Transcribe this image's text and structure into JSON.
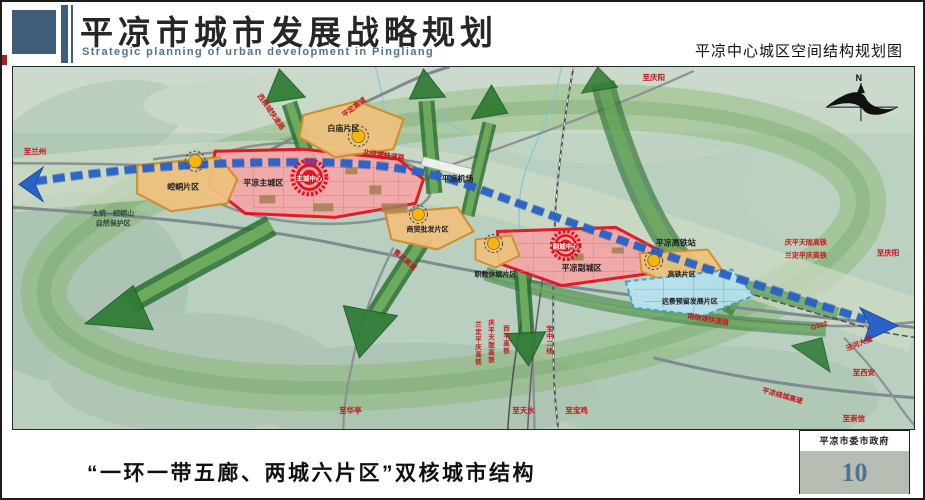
{
  "header": {
    "title_cn": "平凉市城市发展战略规划",
    "title_en": "Strategic planning of urban development in Pingliang",
    "subtitle_right": "平凉中心城区空间结构规划图"
  },
  "footer": {
    "caption": "“一环一带五廊、两城六片区”双核城市结构",
    "org": "平凉市委市政府",
    "page_number": "10"
  },
  "map": {
    "compass": "N",
    "zones": {
      "baimiao": "白庙片区",
      "kongtong": "崆峒片区",
      "main_city": "平凉主城区",
      "main_core": "主城中心",
      "trade": "商贸批发片区",
      "vocational": "职教休娱片区",
      "sub_city": "平凉副城区",
      "sub_core": "副城中心",
      "hsr_zone": "高铁片区",
      "reserve_dev": "远景预留发展片区"
    },
    "places": {
      "airport": "平凉机场",
      "hsr_station": "平凉高铁站",
      "nature_reserve_1": "太统—崆峒山",
      "nature_reserve_2": "自然保护区"
    },
    "roads": {
      "pingding_expwy": "平定高速",
      "west_ring": "西绕城快速路",
      "north_ring": "北绕城快速路",
      "qinglan_expwy": "青兰高速",
      "south_ring": "南绕城快速路",
      "pl_ring_expwy": "平凉绕城高速",
      "g312": "G312",
      "jinghe_ave": "泾河大道",
      "qptl_hsr": "庆平天陇高铁",
      "ldpq_hsr": "兰定平庆高铁",
      "xiping_rail": "西平高铁",
      "baozhong_rail": "宝中二线"
    },
    "directions": {
      "to_lanzhou": "至兰州",
      "to_qingyang_n": "至庆阳",
      "to_qingyang_e": "至庆阳",
      "to_xian": "至西安",
      "to_chongxin": "至崇信",
      "to_huating": "至华亭",
      "to_tianshui": "至天水",
      "to_baoji": "至宝鸡"
    },
    "colors": {
      "accent_blue": "#3f5d78",
      "title_red": "#a82019",
      "belt_blue": "#2a63c8",
      "corridor_green": "#2e7a33",
      "core_red": "#e5121f",
      "zone_orange": "#eec27e",
      "zone_pink": "#f2a8a8",
      "zone_cyan": "#b9e3ef"
    }
  }
}
